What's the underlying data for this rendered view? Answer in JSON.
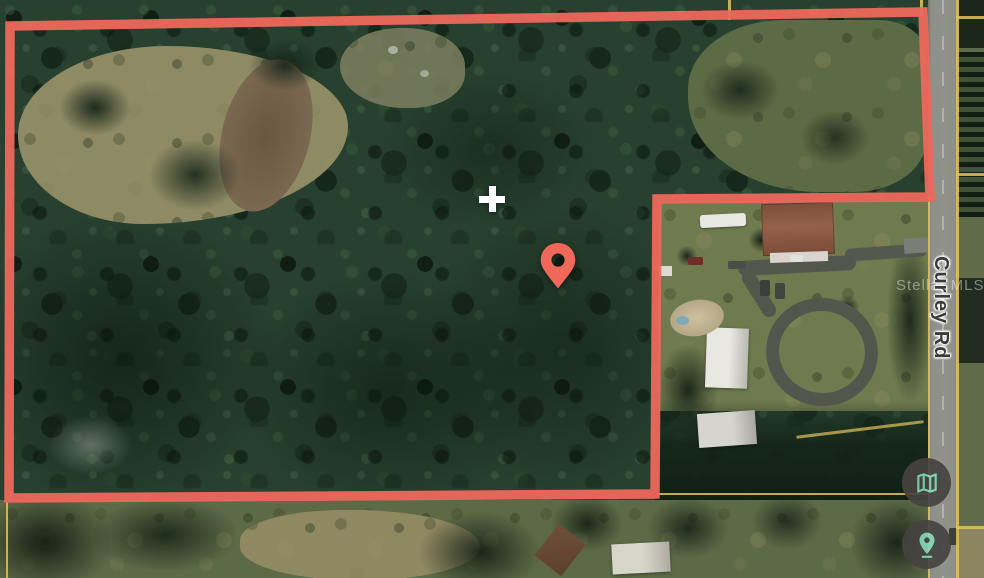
{
  "map": {
    "view_type": "satellite",
    "road_label": "Curley Rd",
    "watermark": "Stellar MLS",
    "boundary": {
      "color": "#ED685C",
      "stroke_width": 9.5,
      "points": "10,26 923,12 930,197 657,199 655,494 9,498"
    },
    "parcel_lines": {
      "color": "#E3C35B"
    },
    "marker_pin": {
      "color": "#F0685A"
    },
    "center_cross": {
      "color": "#FFFFFF"
    },
    "controls": {
      "background": "#454341",
      "icon_color": "#85D7B6",
      "buttons": [
        {
          "name": "map-view",
          "icon": "trifold-map-icon"
        },
        {
          "name": "street-view",
          "icon": "location-pin-icon"
        }
      ]
    }
  }
}
